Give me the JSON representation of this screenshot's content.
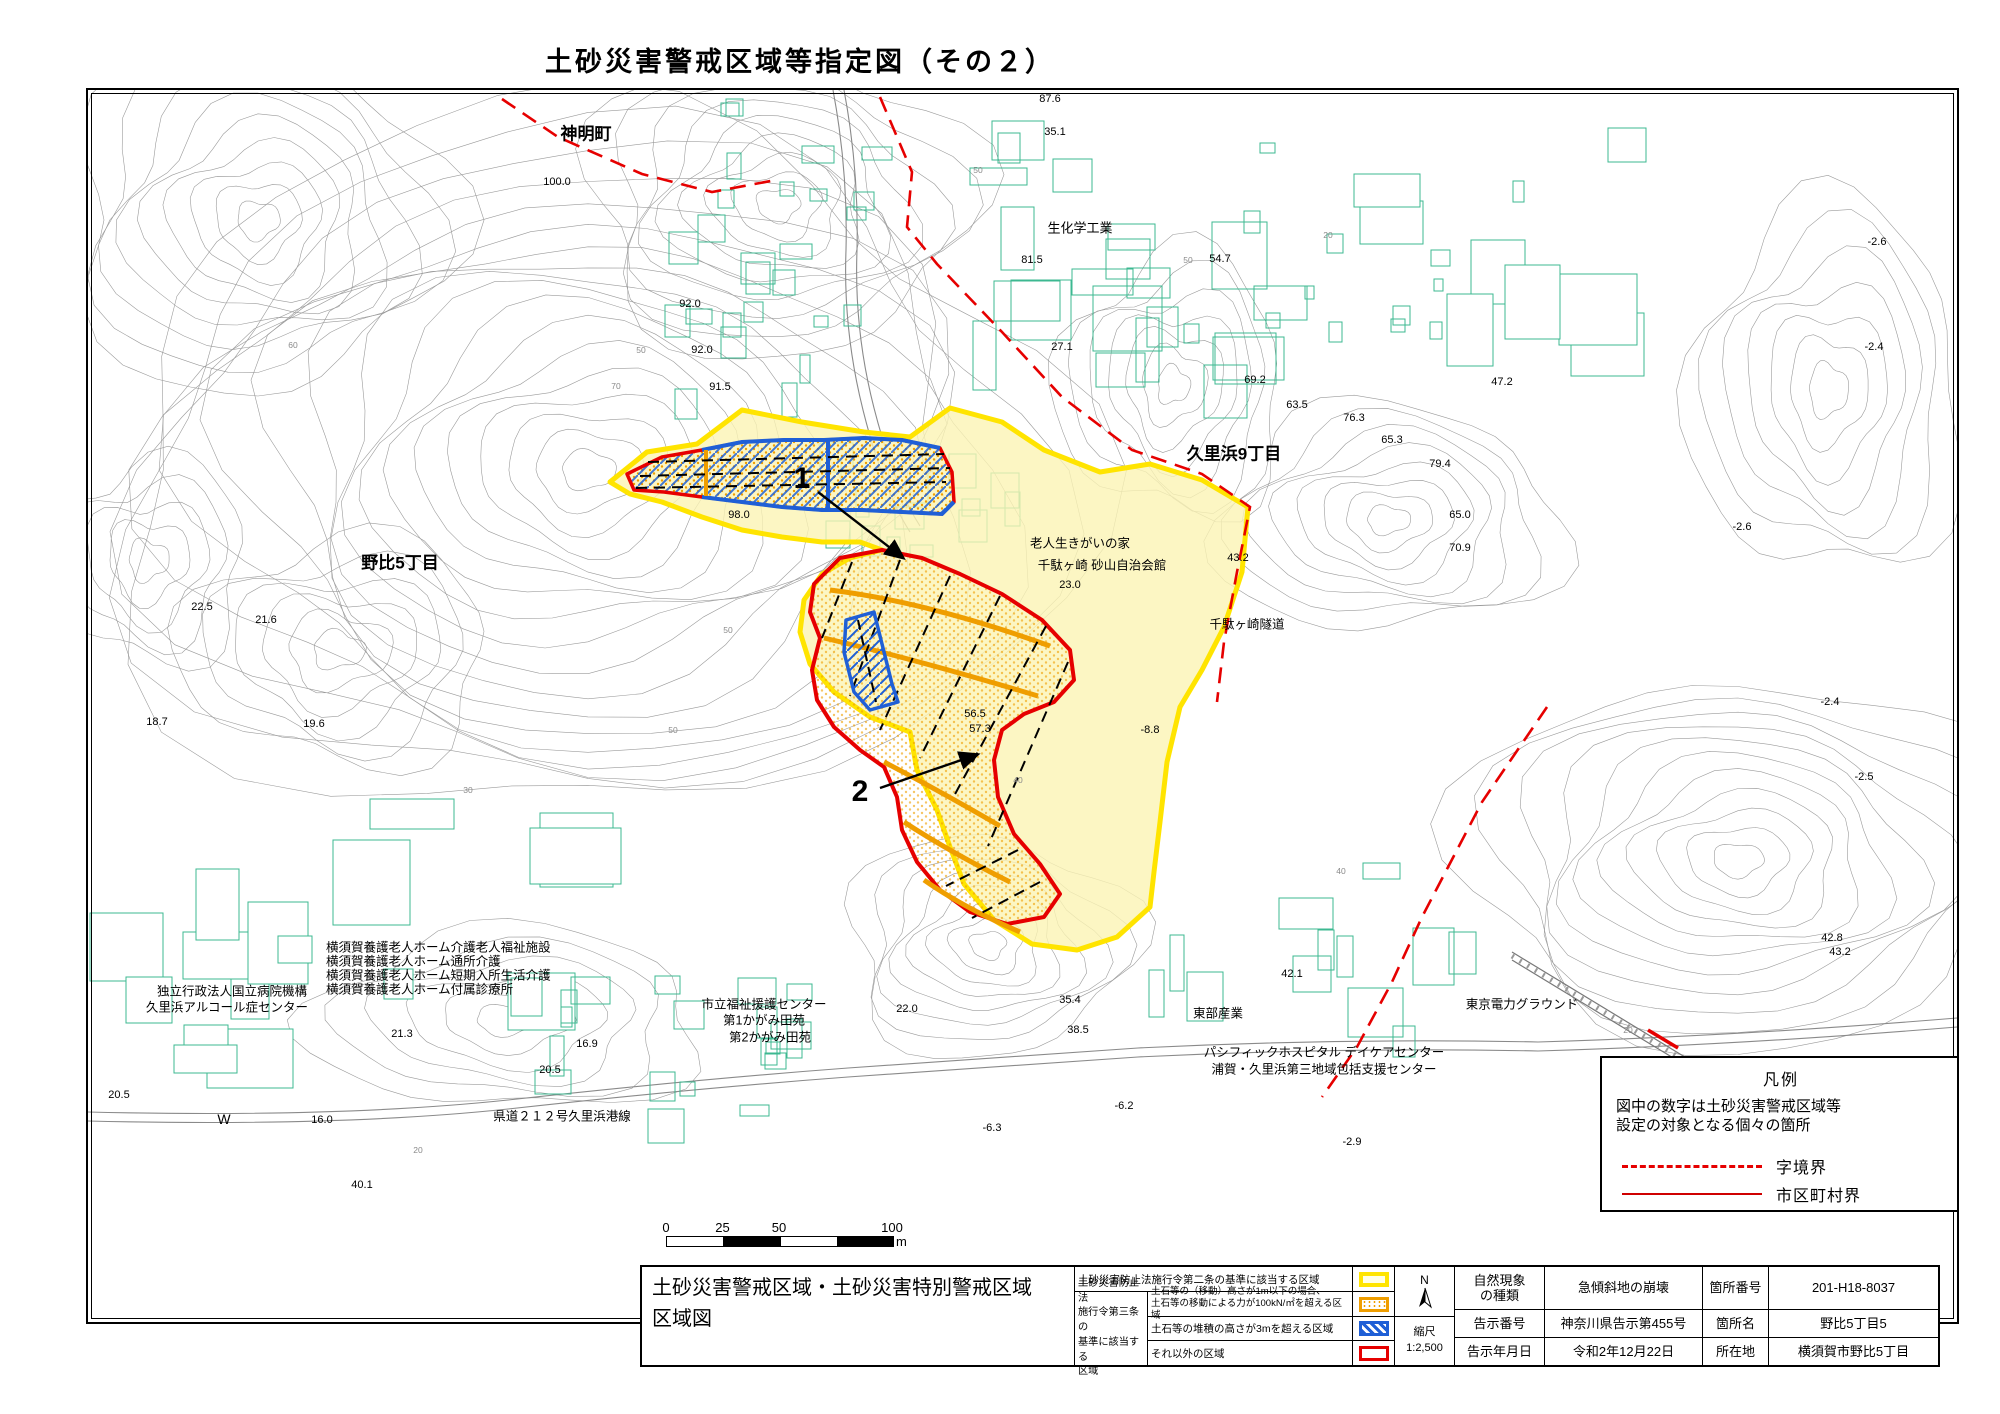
{
  "title": "土砂災害警戒区域等指定図（その２）",
  "colors": {
    "zone_yellow_border": "#ffe400",
    "zone_yellow_fill": "#fbf4b4",
    "zone_orange": "#ef9e00",
    "zone_blue": "#1f5fd6",
    "zone_red": "#e60000",
    "boundary_red": "#e60000",
    "building": "#3cb891",
    "contour": "#9b9b9b",
    "road": "#8a8a8a"
  },
  "map": {
    "area_labels": [
      {
        "text": "神明町",
        "x": 498,
        "y": 42,
        "size": 17,
        "bold": true
      },
      {
        "text": "生化学工業",
        "x": 992,
        "y": 137,
        "size": 13,
        "bold": false
      },
      {
        "text": "久里浜9丁目",
        "x": 1146,
        "y": 362,
        "size": 17,
        "bold": true
      },
      {
        "text": "野比5丁目",
        "x": 312,
        "y": 471,
        "size": 17,
        "bold": true
      },
      {
        "text": "老人生きがいの家",
        "x": 992,
        "y": 452,
        "size": 12.5,
        "bold": false
      },
      {
        "text": "千駄ヶ崎 砂山自治会館",
        "x": 1014,
        "y": 474,
        "size": 12.5,
        "bold": false
      },
      {
        "text": "千駄ヶ崎隧道",
        "x": 1159,
        "y": 533,
        "size": 12.5,
        "bold": false
      },
      {
        "text": "独立行政法人国立病院機構",
        "x": 144,
        "y": 900,
        "size": 12.5,
        "bold": false
      },
      {
        "text": "久里浜アルコール症センター",
        "x": 139,
        "y": 916,
        "size": 12.5,
        "bold": false
      },
      {
        "text": "横須賀養護老人ホーム介護老人福祉施設",
        "x": 238,
        "y": 856,
        "size": 12.5,
        "bold": false,
        "align": "left"
      },
      {
        "text": "横須賀養護老人ホーム通所介護",
        "x": 238,
        "y": 870,
        "size": 12.5,
        "bold": false,
        "align": "left"
      },
      {
        "text": "横須賀養護老人ホーム短期入所生活介護",
        "x": 238,
        "y": 884,
        "size": 12.5,
        "bold": false,
        "align": "left"
      },
      {
        "text": "横須賀養護老人ホーム付属診療所",
        "x": 238,
        "y": 898,
        "size": 12.5,
        "bold": false,
        "align": "left"
      },
      {
        "text": "市立福祉援護センター",
        "x": 676,
        "y": 913,
        "size": 12.5,
        "bold": false
      },
      {
        "text": "第1かがみ田苑",
        "x": 676,
        "y": 929,
        "size": 12.5,
        "bold": false
      },
      {
        "text": "第2かがみ田苑",
        "x": 682,
        "y": 946,
        "size": 12.5,
        "bold": false
      },
      {
        "text": "県道２１２号久里浜港線",
        "x": 474,
        "y": 1025,
        "size": 12.5,
        "bold": false
      },
      {
        "text": "東部産業",
        "x": 1130,
        "y": 922,
        "size": 12.5,
        "bold": false
      },
      {
        "text": "パシフィックホスピタル デイケアセンター",
        "x": 1236,
        "y": 961,
        "size": 12.5,
        "bold": false
      },
      {
        "text": "浦賀・久里浜第三地域包括支援センター",
        "x": 1236,
        "y": 978,
        "size": 12.5,
        "bold": false
      },
      {
        "text": "東京電力グラウンド",
        "x": 1434,
        "y": 913,
        "size": 12.5,
        "bold": false
      },
      {
        "text": "W",
        "x": 136,
        "y": 1029,
        "size": 14,
        "bold": false
      }
    ],
    "spot_elevations": [
      {
        "v": "87.6",
        "x": 962,
        "y": 9
      },
      {
        "v": "35.1",
        "x": 967,
        "y": 42
      },
      {
        "v": "100.0",
        "x": 469,
        "y": 92
      },
      {
        "v": "81.5",
        "x": 944,
        "y": 170
      },
      {
        "v": "54.7",
        "x": 1132,
        "y": 169
      },
      {
        "v": "92.0",
        "x": 602,
        "y": 214
      },
      {
        "v": "92.0",
        "x": 614,
        "y": 260
      },
      {
        "v": "27.1",
        "x": 974,
        "y": 257
      },
      {
        "v": "91.5",
        "x": 632,
        "y": 297
      },
      {
        "v": "69.2",
        "x": 1167,
        "y": 290
      },
      {
        "v": "47.2",
        "x": 1414,
        "y": 292
      },
      {
        "v": "63.5",
        "x": 1209,
        "y": 315
      },
      {
        "v": "76.3",
        "x": 1266,
        "y": 328
      },
      {
        "v": "65.3",
        "x": 1304,
        "y": 350
      },
      {
        "v": "79.4",
        "x": 1352,
        "y": 374
      },
      {
        "v": "23.0",
        "x": 982,
        "y": 495
      },
      {
        "v": "65.0",
        "x": 1372,
        "y": 425
      },
      {
        "v": "98.0",
        "x": 651,
        "y": 425
      },
      {
        "v": "70.9",
        "x": 1372,
        "y": 458
      },
      {
        "v": "43.2",
        "x": 1150,
        "y": 468
      },
      {
        "v": "22.5",
        "x": 114,
        "y": 517
      },
      {
        "v": "21.6",
        "x": 178,
        "y": 530
      },
      {
        "v": "56.5",
        "x": 887,
        "y": 624
      },
      {
        "v": "57.3",
        "x": 892,
        "y": 639
      },
      {
        "v": "-8.8",
        "x": 1062,
        "y": 640
      },
      {
        "v": "18.7",
        "x": 69,
        "y": 632
      },
      {
        "v": "19.6",
        "x": 226,
        "y": 634
      },
      {
        "v": "42.8",
        "x": 1744,
        "y": 848
      },
      {
        "v": "43.2",
        "x": 1752,
        "y": 862
      },
      {
        "v": "42.1",
        "x": 1204,
        "y": 884
      },
      {
        "v": "22.0",
        "x": 819,
        "y": 919
      },
      {
        "v": "35.4",
        "x": 982,
        "y": 910
      },
      {
        "v": "38.5",
        "x": 990,
        "y": 940
      },
      {
        "v": "16.9",
        "x": 499,
        "y": 954
      },
      {
        "v": "21.3",
        "x": 314,
        "y": 944
      },
      {
        "v": "20.5",
        "x": 31,
        "y": 1005
      },
      {
        "v": "20.5",
        "x": 462,
        "y": 980
      },
      {
        "v": "16.0",
        "x": 234,
        "y": 1030
      },
      {
        "v": "40.1",
        "x": 274,
        "y": 1095
      },
      {
        "v": "-6.3",
        "x": 904,
        "y": 1038
      },
      {
        "v": "-6.2",
        "x": 1036,
        "y": 1016
      },
      {
        "v": "-2.9",
        "x": 1264,
        "y": 1052
      },
      {
        "v": "-2.6",
        "x": 1789,
        "y": 152
      },
      {
        "v": "-2.4",
        "x": 1786,
        "y": 257
      },
      {
        "v": "-2.6",
        "x": 1654,
        "y": 437
      },
      {
        "v": "-2.4",
        "x": 1742,
        "y": 612
      },
      {
        "v": "-2.5",
        "x": 1776,
        "y": 687
      }
    ],
    "contour_labels": [
      {
        "t": "50",
        "x": 890,
        "y": 80
      },
      {
        "t": "50",
        "x": 553,
        "y": 260
      },
      {
        "t": "70",
        "x": 528,
        "y": 296
      },
      {
        "t": "60",
        "x": 205,
        "y": 255
      },
      {
        "t": "50",
        "x": 585,
        "y": 640
      },
      {
        "t": "30",
        "x": 380,
        "y": 700
      },
      {
        "t": "40",
        "x": 1253,
        "y": 781
      },
      {
        "t": "20",
        "x": 1540,
        "y": 940
      },
      {
        "t": "20",
        "x": 330,
        "y": 1060
      },
      {
        "t": "50",
        "x": 1100,
        "y": 170
      },
      {
        "t": "20",
        "x": 1240,
        "y": 145
      },
      {
        "t": "40",
        "x": 930,
        "y": 690
      },
      {
        "t": "50",
        "x": 640,
        "y": 540
      }
    ],
    "zone_callouts": [
      {
        "label": "1",
        "lx": 714,
        "ly": 389,
        "x1": 730,
        "y1": 402,
        "x2": 814,
        "y2": 467
      },
      {
        "label": "2",
        "lx": 772,
        "ly": 702,
        "x1": 792,
        "y1": 698,
        "x2": 888,
        "y2": 665
      }
    ]
  },
  "legend_box": {
    "title": "凡例",
    "note_line1": "図中の数字は土砂災害警戒区域等",
    "note_line2": "設定の対象となる個々の箇所",
    "items": [
      {
        "style": "dashed",
        "label": "字境界"
      },
      {
        "style": "solid",
        "label": "市区町村界"
      }
    ]
  },
  "scale_bar": {
    "ticks": [
      "0",
      "25",
      "50",
      "100"
    ],
    "unit": "m"
  },
  "title_block": {
    "map_title_line1": "土砂災害警戒区域・土砂災害特別警戒区域",
    "map_title_line2": "区域図",
    "row1_desc": "土砂災害防止法施行令第二条の基準に該当する区域",
    "group_label_lines": [
      "土砂災害防止法",
      "施行令第三条の",
      "基準に該当する",
      "区域"
    ],
    "row2_desc_lines": [
      "土石等の（移動）高さが1m以下の場合、",
      "土石等の移動による力が100kN/㎡を超える区域"
    ],
    "row3_desc": "土石等の堆積の高さが3mを超える区域",
    "row4_desc": "それ以外の区域",
    "north_label": "N",
    "scale_label": "縮尺",
    "scale_value": "1:2,500",
    "info_rows": [
      {
        "l1": [
          "自然現象",
          "の種類"
        ],
        "v1": "急傾斜地の崩壊",
        "l2": [
          "箇所番号"
        ],
        "v2": "201-H18-8037"
      },
      {
        "l1": [
          "告示番号"
        ],
        "v1": "神奈川県告示第455号",
        "l2": [
          "箇所名"
        ],
        "v2": "野比5丁目5"
      },
      {
        "l1": [
          "告示年月日"
        ],
        "v1": "令和2年12月22日",
        "l2": [
          "所在地"
        ],
        "v2": "横須賀市野比5丁目"
      }
    ]
  }
}
